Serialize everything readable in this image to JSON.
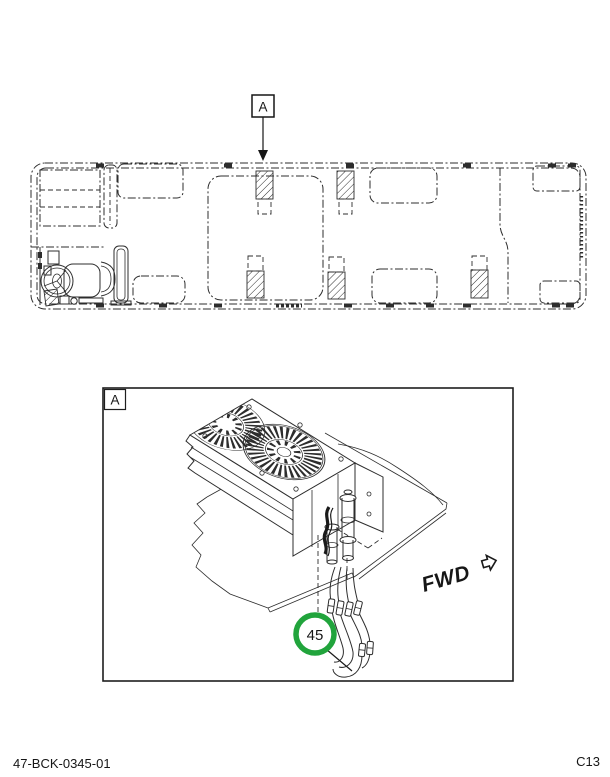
{
  "figure": {
    "overview_callout": "A",
    "detail_label": "A",
    "part_number": "45",
    "direction_label": "FWD"
  },
  "footer": {
    "doc_number": "47-BCK-0345-01",
    "page_code": "C13"
  },
  "colors": {
    "callout_green": "#21a43c",
    "line": "#2d2d2d"
  }
}
